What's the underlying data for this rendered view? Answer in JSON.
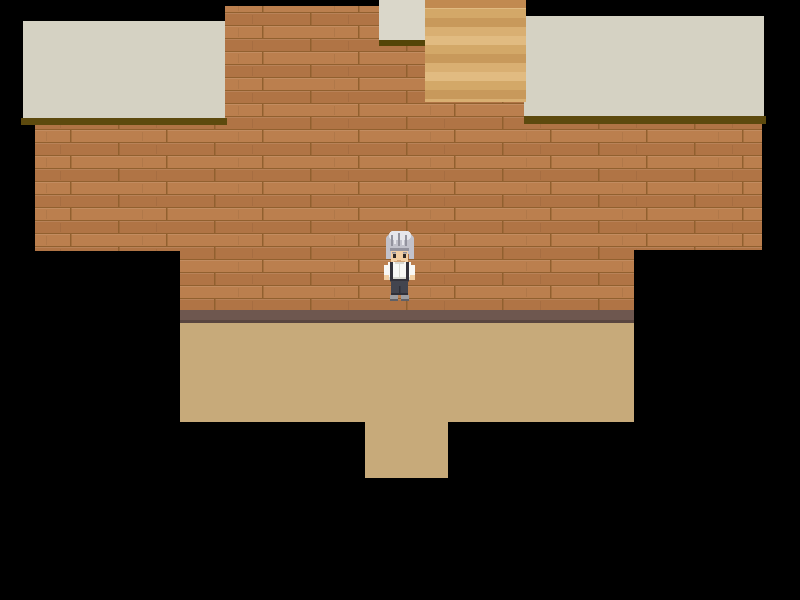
{
  "scene": {
    "background": "#000000",
    "ceiling": "#d5d2c3",
    "ceiling_shadow": "#5d4a0e",
    "doorway_panel": "#dad7ca",
    "doorway_shadow": "#544508",
    "brick_row_a": "#bb7f4e",
    "brick_row_b": "#b07445",
    "brick_line": "#91602f",
    "wood_top": "#c18a50",
    "wood_band_a": "#e1bb81",
    "wood_band_b": "#d3a868",
    "wood_band_c": "#c8995b",
    "wood_band_d": "#d9af72",
    "baseboard": "#6e574f",
    "baseboard_shadow": "#5a463f",
    "floor": "#c7aa7a"
  },
  "character": {
    "hair_light": "#e6e6eb",
    "hair": "#c2c2cb",
    "hair_dark": "#93939e",
    "skin": "#f2cfa3",
    "skin_shadow": "#d2a274",
    "eye": "#2e2a28",
    "shirt": "#f8f8f5",
    "shirt_shadow": "#d9d9d2",
    "strap": "#33323a",
    "pants": "#43454f",
    "pants_shadow": "#2f3039",
    "shoe": "#9d9da1",
    "shoe_shadow": "#606066"
  }
}
